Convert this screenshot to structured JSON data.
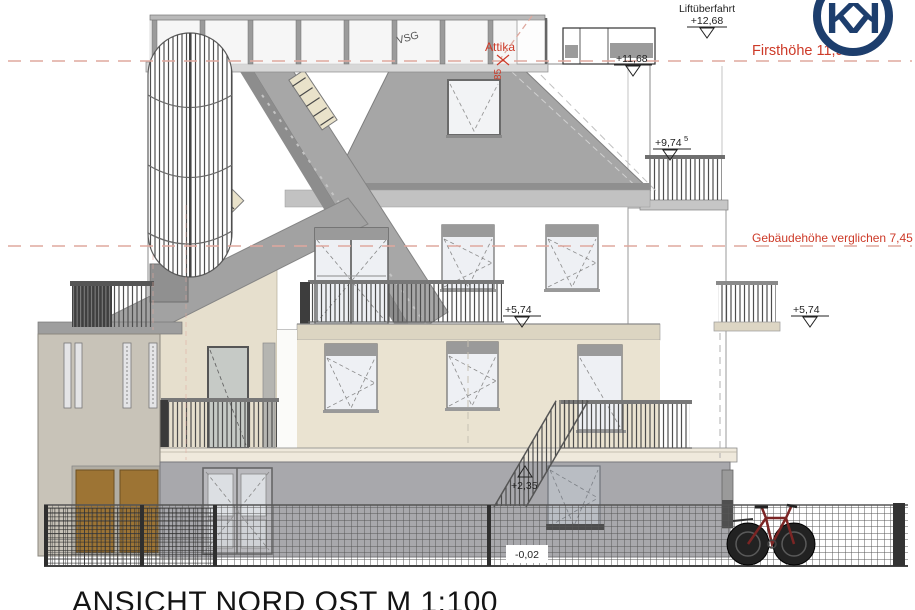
{
  "document": {
    "title": "ANSICHT NORD OST M 1:100",
    "logo_letter": "K"
  },
  "red_annotations": {
    "ridge_height": "Firsthöhe 11,95m",
    "building_height_compare": "Gebäudehöhe verglichen 7,45",
    "attika": "Attika",
    "attika_dim": "85"
  },
  "levels": {
    "lift_overrun_label": "Liftüberfahrt",
    "lift_overrun": "+12,68",
    "attika_level": "+11,68",
    "terrace_level": "+9,74",
    "terrace_level_sup": "5",
    "upper_level_mid": "+5,74",
    "upper_level_right": "+5,74",
    "first_level": "+2,35",
    "ground_level": "-0,02"
  },
  "materials": {
    "glass_label": "VSG"
  },
  "colors": {
    "annotation_red": "#cd3a28",
    "dashed_red": "#dfa89e",
    "logo_navy": "#1d3e6d",
    "facade_beige": "#eae3d1",
    "ground_gray": "#a8a8ac",
    "roof_gray": "#a6a6a6",
    "left_wing_tan": "#c8c3b8",
    "door_brown": "#9d7434",
    "bike_frame_red": "#7b2524"
  }
}
